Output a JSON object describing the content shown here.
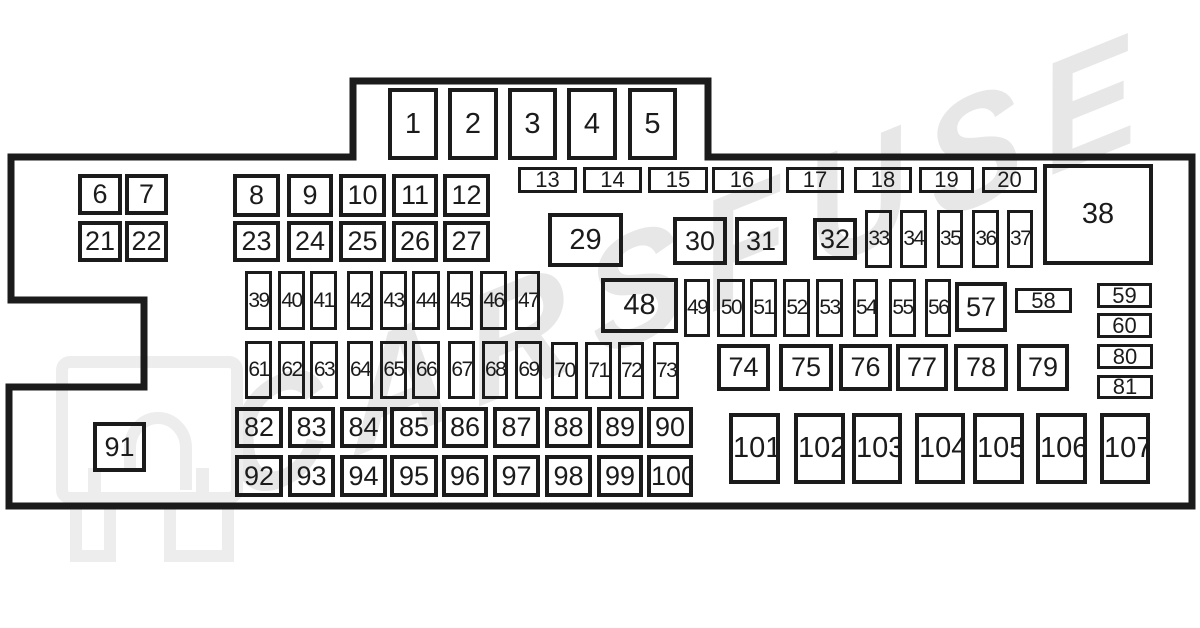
{
  "diagram": {
    "title": "fuse-box-diagram",
    "background_color": "#ffffff",
    "line_color": "#1b1b1b",
    "outline_path": "M 11 157 L 353 157 L 353 81 L 708 81 L 708 157 L 1192 157 L 1192 506 L 9 506 L 9 387 L 144 387 L 144 300 L 11 300 Z",
    "outline_stroke_width": "7",
    "watermark": {
      "text": "CARSFUSE",
      "color": "#e7e7e7",
      "logo_color": "#ededed"
    },
    "missing_numbers": [
      "28"
    ],
    "fuses": [
      {
        "n": "1",
        "x": 388,
        "y": 88,
        "w": 50,
        "h": 72
      },
      {
        "n": "2",
        "x": 448,
        "y": 88,
        "w": 50,
        "h": 72
      },
      {
        "n": "3",
        "x": 508,
        "y": 88,
        "w": 49,
        "h": 72
      },
      {
        "n": "4",
        "x": 567,
        "y": 88,
        "w": 50,
        "h": 72
      },
      {
        "n": "5",
        "x": 628,
        "y": 88,
        "w": 49,
        "h": 72
      },
      {
        "n": "6",
        "x": 78,
        "y": 174,
        "w": 44,
        "h": 41
      },
      {
        "n": "7",
        "x": 125,
        "y": 174,
        "w": 43,
        "h": 41
      },
      {
        "n": "8",
        "x": 233,
        "y": 174,
        "w": 47,
        "h": 43
      },
      {
        "n": "9",
        "x": 287,
        "y": 174,
        "w": 46,
        "h": 43
      },
      {
        "n": "10",
        "x": 339,
        "y": 174,
        "w": 47,
        "h": 43
      },
      {
        "n": "11",
        "x": 392,
        "y": 174,
        "w": 46,
        "h": 43
      },
      {
        "n": "12",
        "x": 443,
        "y": 174,
        "w": 47,
        "h": 43
      },
      {
        "n": "13",
        "x": 518,
        "y": 167,
        "w": 59,
        "h": 26
      },
      {
        "n": "14",
        "x": 583,
        "y": 167,
        "w": 59,
        "h": 26
      },
      {
        "n": "15",
        "x": 648,
        "y": 167,
        "w": 60,
        "h": 26
      },
      {
        "n": "16",
        "x": 712,
        "y": 167,
        "w": 60,
        "h": 26
      },
      {
        "n": "17",
        "x": 786,
        "y": 167,
        "w": 58,
        "h": 26
      },
      {
        "n": "18",
        "x": 854,
        "y": 167,
        "w": 58,
        "h": 26
      },
      {
        "n": "19",
        "x": 919,
        "y": 167,
        "w": 55,
        "h": 26
      },
      {
        "n": "20",
        "x": 982,
        "y": 167,
        "w": 55,
        "h": 26
      },
      {
        "n": "21",
        "x": 78,
        "y": 221,
        "w": 44,
        "h": 41
      },
      {
        "n": "22",
        "x": 125,
        "y": 221,
        "w": 43,
        "h": 41
      },
      {
        "n": "23",
        "x": 233,
        "y": 221,
        "w": 47,
        "h": 41
      },
      {
        "n": "24",
        "x": 287,
        "y": 221,
        "w": 46,
        "h": 41
      },
      {
        "n": "25",
        "x": 339,
        "y": 221,
        "w": 47,
        "h": 41
      },
      {
        "n": "26",
        "x": 392,
        "y": 221,
        "w": 46,
        "h": 41
      },
      {
        "n": "27",
        "x": 443,
        "y": 221,
        "w": 47,
        "h": 41
      },
      {
        "n": "29",
        "x": 548,
        "y": 213,
        "w": 75,
        "h": 54
      },
      {
        "n": "30",
        "x": 673,
        "y": 217,
        "w": 54,
        "h": 48
      },
      {
        "n": "31",
        "x": 735,
        "y": 217,
        "w": 52,
        "h": 48
      },
      {
        "n": "32",
        "x": 813,
        "y": 218,
        "w": 44,
        "h": 42
      },
      {
        "n": "33",
        "x": 865,
        "y": 210,
        "w": 27,
        "h": 58
      },
      {
        "n": "34",
        "x": 900,
        "y": 210,
        "w": 27,
        "h": 58
      },
      {
        "n": "35",
        "x": 937,
        "y": 210,
        "w": 26,
        "h": 58
      },
      {
        "n": "36",
        "x": 972,
        "y": 210,
        "w": 27,
        "h": 58
      },
      {
        "n": "37",
        "x": 1007,
        "y": 210,
        "w": 26,
        "h": 58
      },
      {
        "n": "38",
        "x": 1043,
        "y": 164,
        "w": 110,
        "h": 101
      },
      {
        "n": "39",
        "x": 245,
        "y": 271,
        "w": 27,
        "h": 59
      },
      {
        "n": "40",
        "x": 278,
        "y": 271,
        "w": 27,
        "h": 59
      },
      {
        "n": "41",
        "x": 310,
        "y": 271,
        "w": 27,
        "h": 59
      },
      {
        "n": "42",
        "x": 347,
        "y": 271,
        "w": 26,
        "h": 59
      },
      {
        "n": "43",
        "x": 380,
        "y": 271,
        "w": 27,
        "h": 59
      },
      {
        "n": "44",
        "x": 412,
        "y": 271,
        "w": 28,
        "h": 59
      },
      {
        "n": "45",
        "x": 447,
        "y": 271,
        "w": 26,
        "h": 59
      },
      {
        "n": "46",
        "x": 480,
        "y": 271,
        "w": 27,
        "h": 59
      },
      {
        "n": "47",
        "x": 515,
        "y": 271,
        "w": 25,
        "h": 59
      },
      {
        "n": "48",
        "x": 601,
        "y": 278,
        "w": 77,
        "h": 55
      },
      {
        "n": "49",
        "x": 684,
        "y": 279,
        "w": 26,
        "h": 58
      },
      {
        "n": "50",
        "x": 717,
        "y": 279,
        "w": 28,
        "h": 58
      },
      {
        "n": "51",
        "x": 750,
        "y": 279,
        "w": 27,
        "h": 58
      },
      {
        "n": "52",
        "x": 783,
        "y": 279,
        "w": 27,
        "h": 58
      },
      {
        "n": "53",
        "x": 816,
        "y": 279,
        "w": 27,
        "h": 58
      },
      {
        "n": "54",
        "x": 853,
        "y": 279,
        "w": 25,
        "h": 58
      },
      {
        "n": "55",
        "x": 889,
        "y": 279,
        "w": 27,
        "h": 58
      },
      {
        "n": "56",
        "x": 925,
        "y": 279,
        "w": 26,
        "h": 58
      },
      {
        "n": "57",
        "x": 955,
        "y": 282,
        "w": 52,
        "h": 50
      },
      {
        "n": "58",
        "x": 1015,
        "y": 288,
        "w": 57,
        "h": 25
      },
      {
        "n": "59",
        "x": 1097,
        "y": 283,
        "w": 55,
        "h": 25
      },
      {
        "n": "60",
        "x": 1097,
        "y": 313,
        "w": 55,
        "h": 25
      },
      {
        "n": "61",
        "x": 245,
        "y": 341,
        "w": 27,
        "h": 58
      },
      {
        "n": "62",
        "x": 278,
        "y": 341,
        "w": 27,
        "h": 58
      },
      {
        "n": "63",
        "x": 310,
        "y": 341,
        "w": 28,
        "h": 58
      },
      {
        "n": "64",
        "x": 347,
        "y": 341,
        "w": 26,
        "h": 58
      },
      {
        "n": "65",
        "x": 380,
        "y": 341,
        "w": 27,
        "h": 58
      },
      {
        "n": "66",
        "x": 412,
        "y": 341,
        "w": 28,
        "h": 58
      },
      {
        "n": "67",
        "x": 448,
        "y": 341,
        "w": 27,
        "h": 58
      },
      {
        "n": "68",
        "x": 482,
        "y": 341,
        "w": 26,
        "h": 58
      },
      {
        "n": "69",
        "x": 515,
        "y": 341,
        "w": 27,
        "h": 58
      },
      {
        "n": "70",
        "x": 551,
        "y": 342,
        "w": 27,
        "h": 57
      },
      {
        "n": "71",
        "x": 585,
        "y": 342,
        "w": 27,
        "h": 57
      },
      {
        "n": "72",
        "x": 618,
        "y": 342,
        "w": 26,
        "h": 57
      },
      {
        "n": "73",
        "x": 653,
        "y": 342,
        "w": 26,
        "h": 57
      },
      {
        "n": "74",
        "x": 717,
        "y": 344,
        "w": 53,
        "h": 47
      },
      {
        "n": "75",
        "x": 779,
        "y": 344,
        "w": 54,
        "h": 47
      },
      {
        "n": "76",
        "x": 839,
        "y": 344,
        "w": 53,
        "h": 47
      },
      {
        "n": "77",
        "x": 896,
        "y": 344,
        "w": 52,
        "h": 47
      },
      {
        "n": "78",
        "x": 954,
        "y": 344,
        "w": 54,
        "h": 47
      },
      {
        "n": "79",
        "x": 1017,
        "y": 344,
        "w": 52,
        "h": 47
      },
      {
        "n": "80",
        "x": 1097,
        "y": 344,
        "w": 56,
        "h": 25
      },
      {
        "n": "81",
        "x": 1097,
        "y": 375,
        "w": 56,
        "h": 24
      },
      {
        "n": "82",
        "x": 235,
        "y": 407,
        "w": 48,
        "h": 41
      },
      {
        "n": "83",
        "x": 288,
        "y": 407,
        "w": 47,
        "h": 41
      },
      {
        "n": "84",
        "x": 340,
        "y": 407,
        "w": 47,
        "h": 41
      },
      {
        "n": "85",
        "x": 390,
        "y": 407,
        "w": 48,
        "h": 41
      },
      {
        "n": "86",
        "x": 442,
        "y": 407,
        "w": 46,
        "h": 41
      },
      {
        "n": "87",
        "x": 493,
        "y": 407,
        "w": 47,
        "h": 41
      },
      {
        "n": "88",
        "x": 545,
        "y": 407,
        "w": 47,
        "h": 41
      },
      {
        "n": "89",
        "x": 597,
        "y": 407,
        "w": 46,
        "h": 41
      },
      {
        "n": "90",
        "x": 647,
        "y": 407,
        "w": 46,
        "h": 41
      },
      {
        "n": "91",
        "x": 93,
        "y": 422,
        "w": 53,
        "h": 50
      },
      {
        "n": "92",
        "x": 235,
        "y": 455,
        "w": 48,
        "h": 42
      },
      {
        "n": "93",
        "x": 288,
        "y": 455,
        "w": 47,
        "h": 42
      },
      {
        "n": "94",
        "x": 340,
        "y": 455,
        "w": 47,
        "h": 42
      },
      {
        "n": "95",
        "x": 390,
        "y": 455,
        "w": 48,
        "h": 42
      },
      {
        "n": "96",
        "x": 442,
        "y": 455,
        "w": 46,
        "h": 42
      },
      {
        "n": "97",
        "x": 493,
        "y": 455,
        "w": 47,
        "h": 42
      },
      {
        "n": "98",
        "x": 545,
        "y": 455,
        "w": 47,
        "h": 42
      },
      {
        "n": "99",
        "x": 597,
        "y": 455,
        "w": 46,
        "h": 42
      },
      {
        "n": "100",
        "x": 647,
        "y": 455,
        "w": 46,
        "h": 42
      },
      {
        "n": "101",
        "x": 729,
        "y": 413,
        "w": 51,
        "h": 71
      },
      {
        "n": "102",
        "x": 794,
        "y": 413,
        "w": 51,
        "h": 71
      },
      {
        "n": "103",
        "x": 852,
        "y": 413,
        "w": 50,
        "h": 71
      },
      {
        "n": "104",
        "x": 915,
        "y": 413,
        "w": 50,
        "h": 71
      },
      {
        "n": "105",
        "x": 973,
        "y": 413,
        "w": 51,
        "h": 71
      },
      {
        "n": "106",
        "x": 1036,
        "y": 413,
        "w": 51,
        "h": 71
      },
      {
        "n": "107",
        "x": 1100,
        "y": 413,
        "w": 50,
        "h": 71
      }
    ]
  }
}
